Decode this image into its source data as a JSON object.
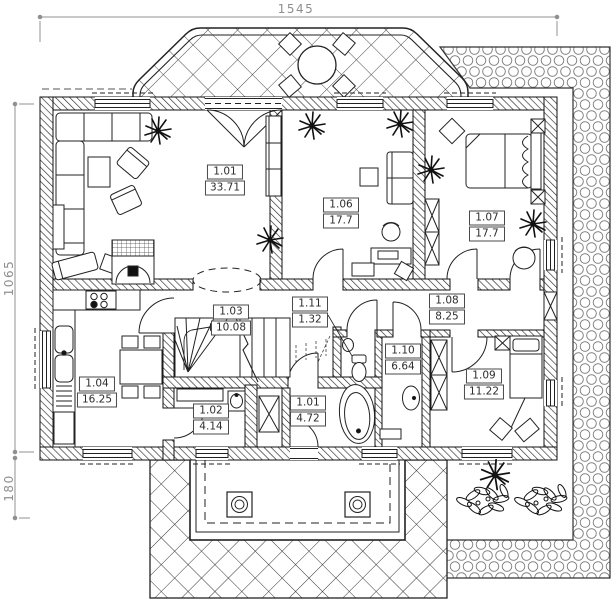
{
  "plan": {
    "dimensions": {
      "width": "1545",
      "height": "1065",
      "porch_depth": "180"
    },
    "rooms": [
      {
        "number": "1.01",
        "area": "33.71"
      },
      {
        "number": "1.06",
        "area": "17.7"
      },
      {
        "number": "1.07",
        "area": "17.7"
      },
      {
        "number": "1.03",
        "area": "10.08"
      },
      {
        "number": "1.11",
        "area": "1.32"
      },
      {
        "number": "1.08",
        "area": "8.25"
      },
      {
        "number": "1.04",
        "area": "16.25"
      },
      {
        "number": "1.10",
        "area": "6.64"
      },
      {
        "number": "1.02",
        "area": "4.14"
      },
      {
        "number": "1.01",
        "area": "4.72"
      },
      {
        "number": "1.09",
        "area": "11.22"
      }
    ],
    "colors": {
      "line": "#1f1f1f",
      "dimension_text": "#8f8f8f",
      "label_text": "#2d2d2d",
      "background": "#ffffff"
    }
  }
}
